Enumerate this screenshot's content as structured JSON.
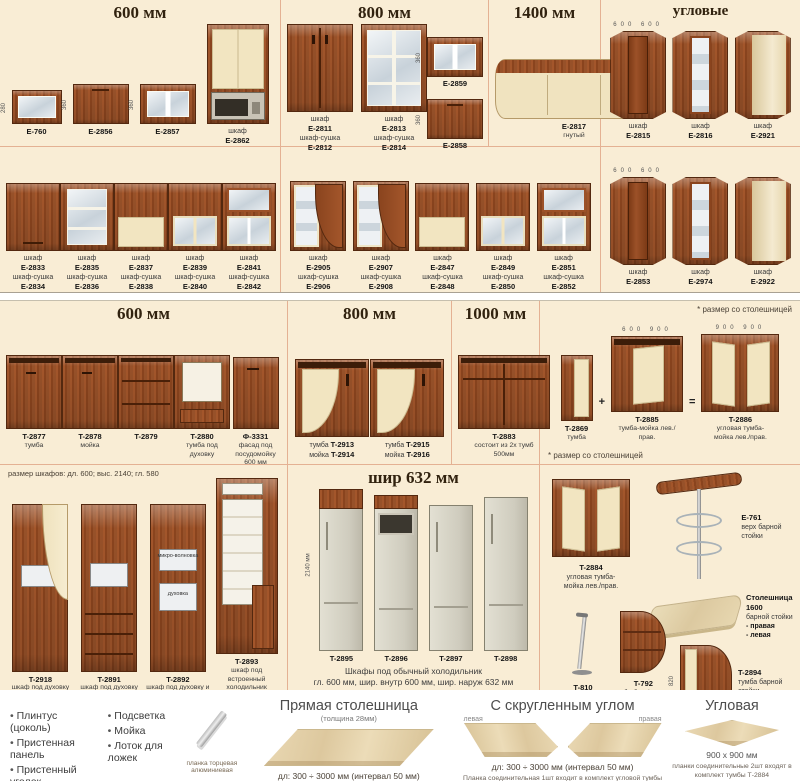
{
  "colors": {
    "page_bg": "#f9edd5",
    "divider": "#e4b193",
    "wood": "#8a441e",
    "cream": "#f2e5c1",
    "glass": "#c8d2da"
  },
  "headers": {
    "r1s1": "600 мм",
    "r1s2": "800 мм",
    "r1s3": "1400 мм",
    "r1s4": "угловые",
    "r3s1": "600 мм",
    "r3s2": "800 мм",
    "r3s3": "1000 мм",
    "r4s2": "шир 632 мм"
  },
  "notes": {
    "worktop_star": "* размер со столешницей",
    "worktop_star2": "* размер со столешницей",
    "tall_sizes": "размер шкафов:   дл. 600;   выс. 2140;   гл. 580",
    "plus": "+",
    "equals": "="
  },
  "r1s1_items": [
    {
      "art": "wall-open",
      "code": "E-760",
      "dim": "280"
    },
    {
      "art": "wall-flip-wood",
      "code": "E-2856",
      "dim": "360"
    },
    {
      "art": "wall-flip-glass",
      "code": "E-2857",
      "dim": "360"
    },
    {
      "art": "tall-micro",
      "label": "шкаф",
      "code": "E-2862"
    }
  ],
  "r1s2_items": [
    {
      "art": "wall-double-wood",
      "label": "шкаф",
      "code": "E-2811",
      "label2": "шкаф-сушка",
      "code2": "E-2812"
    },
    {
      "art": "wall-double-glass",
      "label": "шкаф",
      "code": "E-2813",
      "label2": "шкаф-сушка",
      "code2": "E-2814"
    }
  ],
  "r1s2_stack": [
    {
      "art": "wall-flip-glass",
      "code": "E-2859",
      "dim": "360"
    },
    {
      "art": "wall-flip-wood",
      "code": "E-2858",
      "dim": "360"
    }
  ],
  "r1s3_items": [
    {
      "art": "wide-curved",
      "code": "E-2817",
      "sub": "гнутый"
    }
  ],
  "r1s4_items": [
    {
      "art": "corner-wood",
      "label": "шкаф",
      "code": "E-2815",
      "dimTop": "600 600"
    },
    {
      "art": "corner-glass",
      "label": "шкаф",
      "code": "E-2816"
    },
    {
      "art": "corner-open",
      "label": "шкаф",
      "code": "E-2921"
    }
  ],
  "r2s1_items": [
    {
      "art": "wall-wood",
      "label": "шкаф",
      "code": "E-2833",
      "label2": "шкаф-сушка",
      "code2": "E-2834"
    },
    {
      "art": "wall-glass",
      "label": "шкаф",
      "code": "E-2835",
      "label2": "шкаф-сушка",
      "code2": "E-2836"
    },
    {
      "art": "wall-half",
      "label": "шкаф",
      "code": "E-2837",
      "label2": "шкаф-сушка",
      "code2": "E-2838"
    },
    {
      "art": "wall-half-glass",
      "label": "шкаф",
      "code": "E-2839",
      "label2": "шкаф-сушка",
      "code2": "E-2840"
    },
    {
      "art": "wall-glass2",
      "label": "шкаф",
      "code": "E-2841",
      "label2": "шкаф-сушка",
      "code2": "E-2842"
    }
  ],
  "r2s2_items": [
    {
      "art": "wall-curve-glass",
      "label": "шкаф",
      "code": "E-2905",
      "label2": "шкаф-сушка",
      "code2": "E-2906"
    },
    {
      "art": "wall-curve-glass",
      "label": "шкаф",
      "code": "E-2907",
      "label2": "шкаф-сушка",
      "code2": "E-2908"
    },
    {
      "art": "wall-half",
      "label": "шкаф",
      "code": "E-2847",
      "label2": "шкаф-сушка",
      "code2": "E-2848"
    },
    {
      "art": "wall-half-glass",
      "label": "шкаф",
      "code": "E-2849",
      "label2": "шкаф-сушка",
      "code2": "E-2850"
    },
    {
      "art": "wall-glass2",
      "label": "шкаф",
      "code": "E-2851",
      "label2": "шкаф-сушка",
      "code2": "E-2852"
    }
  ],
  "r2s3_items": [
    {
      "art": "corner-wood",
      "label": "шкаф",
      "code": "E-2853",
      "dimTop": "600 600"
    },
    {
      "art": "corner-glass",
      "label": "шкаф",
      "code": "E-2974"
    },
    {
      "art": "corner-open",
      "label": "шкаф",
      "code": "E-2922"
    }
  ],
  "r3s1_items": [
    {
      "art": "base-wood",
      "code": "T-2877",
      "sub": "тумба"
    },
    {
      "art": "base-sink",
      "code": "T-2878",
      "sub": "мойка"
    },
    {
      "art": "base-drawers",
      "code": "T-2879"
    },
    {
      "art": "base-oven",
      "code": "T-2880",
      "sub": "тумба под духовку"
    },
    {
      "art": "panel",
      "code": "Ф-3331",
      "sub": "фасад под посудомойку 600 мм"
    }
  ],
  "r3s2_items": [
    {
      "art": "base-curve",
      "label": "тумба",
      "code": "T-2913",
      "label2": "мойка",
      "code2": "T-2914"
    },
    {
      "art": "base-curve",
      "label": "тумба",
      "code": "T-2915",
      "label2": "мойка",
      "code2": "T-2916"
    }
  ],
  "r3s3_items": [
    {
      "art": "base-1000",
      "code": "T-2883",
      "sub": "состоит из 2х тумб 500мм"
    }
  ],
  "formula": {
    "a": {
      "code": "T-2869",
      "sub": "тумба"
    },
    "b": {
      "code": "T-2885",
      "sub": "тумба-мойка лев./прав.",
      "dimTop": "600 900"
    },
    "c": {
      "code": "T-2886",
      "sub": "угловая тумба-мойка лев./прав.",
      "dimTop": "900 900"
    }
  },
  "r4s1_items": [
    {
      "art": "tall-curve",
      "code": "T-2918",
      "sub": "шкаф под духовку или микроволновку"
    },
    {
      "art": "tall-drawers",
      "code": "T-2891",
      "sub": "шкаф под духовку или микроволновку"
    },
    {
      "art": "tall-two-niche",
      "code": "T-2892",
      "sub": "шкаф под духовку и микроволновку",
      "inner1": "микро-волновка",
      "inner2": "духовка"
    },
    {
      "art": "tall-fridge",
      "code": "T-2893",
      "sub": "шкаф под встроенный холодильник h=1775"
    }
  ],
  "r4s2_items": [
    {
      "art": "fridge1",
      "code": "T-2895",
      "dimLeft": "2140 мм",
      "dim": "выс. до 1775 мм"
    },
    {
      "art": "fridge2",
      "code": "T-2896",
      "dim": "выс. до 1520 мм"
    },
    {
      "art": "fridge3",
      "code": "T-2897",
      "dim": "выс. до 1930 мм"
    },
    {
      "art": "fridge4",
      "code": "T-2898",
      "dim": "выс. до 2015 мм"
    }
  ],
  "fridge_caption1": "Шкафы под обычный холодильник",
  "fridge_caption2": "гл. 600 мм,    шир. внутр 600 мм,    шир. наруж 632 мм",
  "bar": {
    "t2884": {
      "code": "T-2884",
      "sub": "угловая тумба-мойка лев./прав."
    },
    "e761": {
      "code": "E-761",
      "sub": "верх барной стойки"
    },
    "wtop": {
      "title": "Столешница 1600",
      "sub": "барной стойки",
      "opt1": "- правая",
      "opt2": "- левая",
      "dim": "1600"
    },
    "t810": {
      "code": "T-810",
      "sub": "труба под столешницу"
    },
    "t792": {
      "code": "T-792",
      "sub": "тумба без фасадов"
    },
    "t2894": {
      "code": "T-2894",
      "sub": "тумба барной стойки",
      "dim": "820"
    }
  },
  "bottom": {
    "accessories_col1": [
      "Плинтус (цоколь)",
      "Пристенная панель",
      "Пристенный уголок",
      "Карниз"
    ],
    "accessories_col2": [
      "Подсветка",
      "Мойка",
      "Лоток для ложек"
    ],
    "strip_label": "планка торцевая алюминиевая",
    "w1": {
      "title": "Прямая столешница",
      "sub": "(толщина 28мм)",
      "note": "дл: 300 ÷ 3000 мм (интервал 50 мм)"
    },
    "w2": {
      "title": "С скругленным углом",
      "left": "левая",
      "right": "правая",
      "note": "дл: 300 ÷ 3000 мм (интервал 50 мм)",
      "foot": "Планка соединительная 1шт входит в комплект угловой тумбы Т-2885, 2886"
    },
    "w3": {
      "title": "Угловая",
      "size": "900 х 900 мм",
      "foot": "планки соединительные 2шт входят в комплект тумбы Т-2884"
    }
  }
}
